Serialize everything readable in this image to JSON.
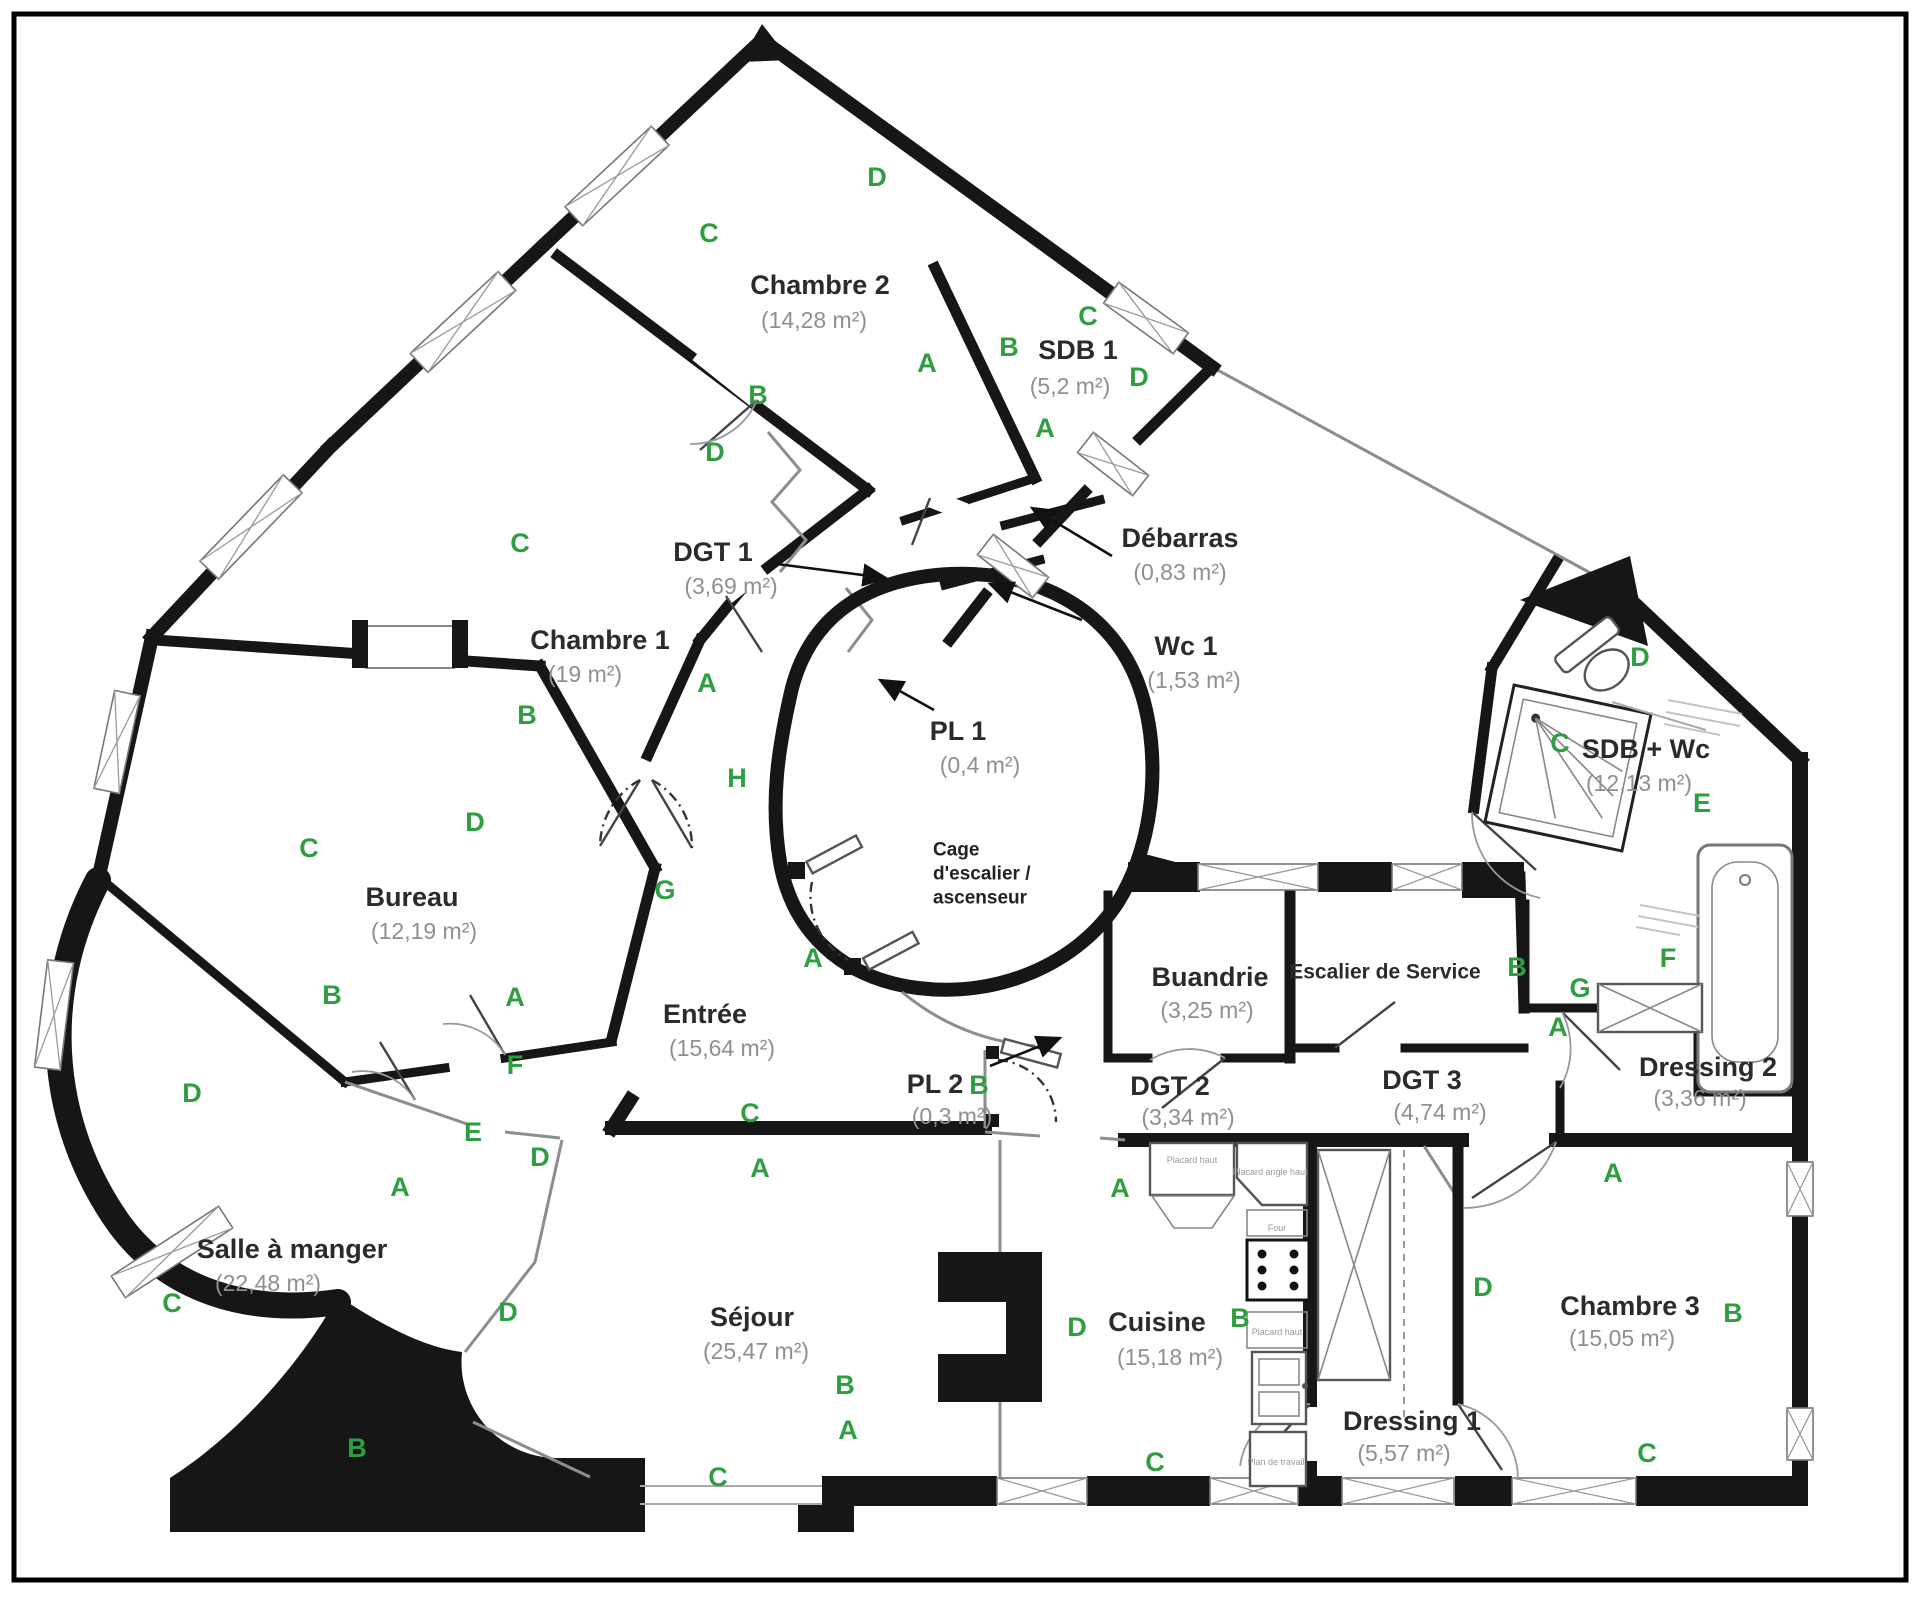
{
  "plan": {
    "type": "apartment-floor-plan",
    "colors": {
      "wall": "#161616",
      "letter_green": "#2f9e41",
      "room_text": "#2b2b2b",
      "area_text": "#8f8f8f",
      "window_line": "#9a9a9a"
    },
    "rooms": [
      {
        "name": "Chambre 2",
        "area": "(14,28 m²)",
        "x": 820,
        "y": 285,
        "ax": 814,
        "ay": 320
      },
      {
        "name": "SDB 1",
        "area": "(5,2 m²)",
        "x": 1078,
        "y": 350,
        "ax": 1070,
        "ay": 386
      },
      {
        "name": "Chambre 1",
        "area": "(19 m²)",
        "x": 600,
        "y": 640,
        "ax": 585,
        "ay": 674
      },
      {
        "name": "Bureau",
        "area": "(12,19 m²)",
        "x": 412,
        "y": 897,
        "ax": 424,
        "ay": 931
      },
      {
        "name": "Entrée",
        "area": "(15,64 m²)",
        "x": 705,
        "y": 1014,
        "ax": 722,
        "ay": 1048
      },
      {
        "name": "Salle à manger",
        "area": "(22,48 m²)",
        "x": 292,
        "y": 1249,
        "ax": 268,
        "ay": 1283
      },
      {
        "name": "Séjour",
        "area": "(25,47 m²)",
        "x": 752,
        "y": 1317,
        "ax": 756,
        "ay": 1351
      },
      {
        "name": "Cuisine",
        "area": "(15,18 m²)",
        "x": 1157,
        "y": 1322,
        "ax": 1170,
        "ay": 1357
      },
      {
        "name": "Buandrie",
        "area": "(3,25 m²)",
        "x": 1210,
        "y": 977,
        "ax": 1207,
        "ay": 1010
      },
      {
        "name": "Escalier de Service",
        "area": "",
        "x": 1385,
        "y": 972,
        "small": true
      },
      {
        "name": "DGT 2",
        "area": "(3,34 m²)",
        "x": 1170,
        "y": 1086,
        "ax": 1188,
        "ay": 1117
      },
      {
        "name": "DGT 3",
        "area": "(4,74 m²)",
        "x": 1422,
        "y": 1080,
        "ax": 1440,
        "ay": 1112
      },
      {
        "name": "Dressing 1",
        "area": "(5,57 m²)",
        "x": 1412,
        "y": 1421,
        "ax": 1404,
        "ay": 1453
      },
      {
        "name": "Dressing 2",
        "area": "(3,36 m²)",
        "x": 1708,
        "y": 1067,
        "ax": 1700,
        "ay": 1098
      },
      {
        "name": "Chambre 3",
        "area": "(15,05 m²)",
        "x": 1630,
        "y": 1306,
        "ax": 1622,
        "ay": 1338
      },
      {
        "name": "SDB + Wc",
        "area": "(12,13 m²)",
        "x": 1646,
        "y": 749,
        "ax": 1639,
        "ay": 783
      }
    ],
    "stairwell": {
      "lines": [
        "Cage",
        "d'escalier /",
        "ascenseur"
      ],
      "x": 933,
      "y": 850,
      "line_height": 24
    },
    "annotations": [
      {
        "name": "DGT 1",
        "area": "(3,69 m²)",
        "tx": 713,
        "ty": 552,
        "ax": 731,
        "ay": 586,
        "arrow": [
          777,
          564,
          886,
          578
        ]
      },
      {
        "name": "Débarras",
        "area": "(0,83 m²)",
        "tx": 1180,
        "ty": 538,
        "ax": 1180,
        "ay": 572,
        "arrow": [
          1112,
          556,
          1032,
          508
        ]
      },
      {
        "name": "Wc 1",
        "area": "(1,53 m²)",
        "tx": 1186,
        "ty": 646,
        "ax": 1194,
        "ay": 680,
        "arrow": [
          1082,
          620,
          990,
          584
        ]
      },
      {
        "name": "PL 1",
        "area": "(0,4 m²)",
        "tx": 958,
        "ty": 731,
        "ax": 980,
        "ay": 765,
        "arrow": [
          934,
          710,
          880,
          680
        ]
      },
      {
        "name": "PL 2",
        "area": "(0,3 m²)",
        "tx": 935,
        "ty": 1084,
        "ax": 952,
        "ay": 1116,
        "arrow": [
          990,
          1066,
          1060,
          1038
        ]
      }
    ],
    "wall_letters": [
      {
        "t": "D",
        "x": 877,
        "y": 177
      },
      {
        "t": "C",
        "x": 709,
        "y": 233
      },
      {
        "t": "A",
        "x": 927,
        "y": 363
      },
      {
        "t": "B",
        "x": 758,
        "y": 395
      },
      {
        "t": "D",
        "x": 715,
        "y": 452
      },
      {
        "t": "C",
        "x": 1088,
        "y": 316
      },
      {
        "t": "B",
        "x": 1009,
        "y": 347
      },
      {
        "t": "D",
        "x": 1139,
        "y": 377
      },
      {
        "t": "A",
        "x": 1045,
        "y": 428
      },
      {
        "t": "C",
        "x": 520,
        "y": 543
      },
      {
        "t": "B",
        "x": 527,
        "y": 715
      },
      {
        "t": "A",
        "x": 707,
        "y": 683
      },
      {
        "t": "H",
        "x": 737,
        "y": 778
      },
      {
        "t": "D",
        "x": 475,
        "y": 822
      },
      {
        "t": "C",
        "x": 309,
        "y": 848
      },
      {
        "t": "G",
        "x": 665,
        "y": 890
      },
      {
        "t": "B",
        "x": 332,
        "y": 995
      },
      {
        "t": "A",
        "x": 515,
        "y": 997
      },
      {
        "t": "F",
        "x": 515,
        "y": 1065
      },
      {
        "t": "A",
        "x": 813,
        "y": 958
      },
      {
        "t": "E",
        "x": 473,
        "y": 1132
      },
      {
        "t": "D",
        "x": 540,
        "y": 1157
      },
      {
        "t": "D",
        "x": 192,
        "y": 1093
      },
      {
        "t": "A",
        "x": 400,
        "y": 1187
      },
      {
        "t": "C",
        "x": 172,
        "y": 1303
      },
      {
        "t": "B",
        "x": 357,
        "y": 1448
      },
      {
        "t": "C",
        "x": 750,
        "y": 1113
      },
      {
        "t": "A",
        "x": 760,
        "y": 1168
      },
      {
        "t": "D",
        "x": 508,
        "y": 1312
      },
      {
        "t": "B",
        "x": 845,
        "y": 1385
      },
      {
        "t": "A",
        "x": 848,
        "y": 1430
      },
      {
        "t": "C",
        "x": 718,
        "y": 1477
      },
      {
        "t": "B",
        "x": 979,
        "y": 1085
      },
      {
        "t": "A",
        "x": 1120,
        "y": 1188
      },
      {
        "t": "D",
        "x": 1077,
        "y": 1327
      },
      {
        "t": "B",
        "x": 1240,
        "y": 1318
      },
      {
        "t": "C",
        "x": 1155,
        "y": 1462
      },
      {
        "t": "D",
        "x": 1640,
        "y": 657
      },
      {
        "t": "C",
        "x": 1560,
        "y": 743
      },
      {
        "t": "E",
        "x": 1702,
        "y": 803
      },
      {
        "t": "F",
        "x": 1668,
        "y": 958
      },
      {
        "t": "G",
        "x": 1580,
        "y": 988
      },
      {
        "t": "B",
        "x": 1517,
        "y": 967
      },
      {
        "t": "A",
        "x": 1558,
        "y": 1027
      },
      {
        "t": "A",
        "x": 1613,
        "y": 1173
      },
      {
        "t": "D",
        "x": 1483,
        "y": 1287
      },
      {
        "t": "B",
        "x": 1733,
        "y": 1313
      },
      {
        "t": "C",
        "x": 1647,
        "y": 1453
      }
    ],
    "fixture_labels": [
      {
        "t": "Placard haut",
        "x": 1192,
        "y": 1160
      },
      {
        "t": "Placard angle haut",
        "x": 1270,
        "y": 1172
      },
      {
        "t": "Four",
        "x": 1277,
        "y": 1228
      },
      {
        "t": "Placard haut",
        "x": 1277,
        "y": 1332
      },
      {
        "t": "Plan de travail",
        "x": 1276,
        "y": 1462
      }
    ]
  }
}
